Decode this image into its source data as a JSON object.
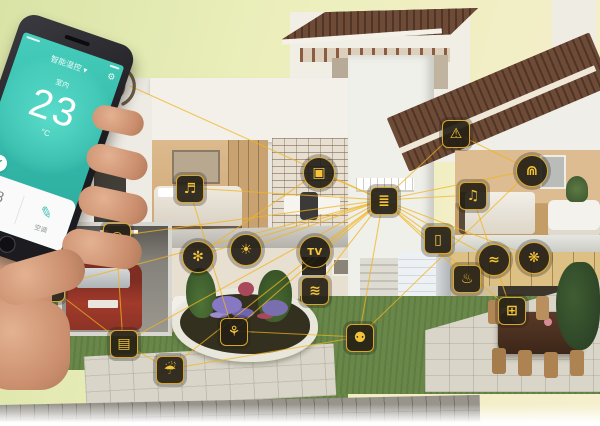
{
  "colors": {
    "accent_line": "#f2b41e",
    "node_glyph": "#f3c339",
    "node_background": "#26201a",
    "app_teal": "#35c0b0",
    "roof_brown": "#5e4030",
    "car_red": "#a13a2b"
  },
  "phone": {
    "app": {
      "title": "智能温控 ▾",
      "gear_icon_glyph": "⚙",
      "room_label": "室内",
      "temperature": "23",
      "unit": "°C",
      "badge_check": "✓",
      "scene_text": "安防模式 · 舒适",
      "sheet_left_value": "18",
      "sheet_left_label": "湿度",
      "sheet_right_glyph": "✎",
      "sheet_right_label": "空调"
    }
  },
  "nodes": [
    {
      "id": "camera",
      "icon": "camera-icon",
      "x": 116,
      "y": 236,
      "shape": "square"
    },
    {
      "id": "ev_charger",
      "icon": "plug-icon",
      "x": 50,
      "y": 287,
      "shape": "square"
    },
    {
      "id": "garage_door",
      "icon": "garage-door-icon",
      "x": 123,
      "y": 343,
      "shape": "square"
    },
    {
      "id": "sprinkler",
      "icon": "sprinkler-icon",
      "x": 169,
      "y": 369,
      "shape": "square"
    },
    {
      "id": "lawn_mower",
      "icon": "lawn-mower-icon",
      "x": 233,
      "y": 331,
      "shape": "square"
    },
    {
      "id": "motion_sensor",
      "icon": "motion-sensor-icon",
      "x": 359,
      "y": 337,
      "shape": "square"
    },
    {
      "id": "speaker",
      "icon": "speaker-icon",
      "x": 189,
      "y": 188,
      "shape": "square"
    },
    {
      "id": "computer",
      "icon": "computer-icon",
      "x": 318,
      "y": 172,
      "shape": "circle"
    },
    {
      "id": "aircon",
      "icon": "air-conditioner-icon",
      "x": 197,
      "y": 256,
      "shape": "circle"
    },
    {
      "id": "bulb",
      "icon": "light-bulb-icon",
      "x": 245,
      "y": 249,
      "shape": "circle"
    },
    {
      "id": "tv",
      "icon": "tv-icon",
      "x": 314,
      "y": 251,
      "shape": "circle",
      "label": "TV"
    },
    {
      "id": "wifi",
      "icon": "wifi-icon",
      "x": 314,
      "y": 290,
      "shape": "square"
    },
    {
      "id": "router",
      "icon": "router-hub-icon",
      "x": 383,
      "y": 200,
      "shape": "square"
    },
    {
      "id": "door_sensor",
      "icon": "door-sensor-icon",
      "x": 437,
      "y": 239,
      "shape": "square"
    },
    {
      "id": "alarm",
      "icon": "alarm-icon",
      "x": 455,
      "y": 133,
      "shape": "square"
    },
    {
      "id": "curtain",
      "icon": "curtain-icon",
      "x": 531,
      "y": 170,
      "shape": "circle"
    },
    {
      "id": "stereo",
      "icon": "stereo-icon",
      "x": 472,
      "y": 195,
      "shape": "square"
    },
    {
      "id": "faucet",
      "icon": "faucet-icon",
      "x": 493,
      "y": 259,
      "shape": "circle"
    },
    {
      "id": "fan",
      "icon": "fan-icon",
      "x": 533,
      "y": 257,
      "shape": "circle"
    },
    {
      "id": "rice_cooker",
      "icon": "rice-cooker-icon",
      "x": 466,
      "y": 278,
      "shape": "square"
    },
    {
      "id": "oven",
      "icon": "oven-icon",
      "x": 511,
      "y": 310,
      "shape": "square"
    },
    {
      "id": "phone_link",
      "icon": "phone-wifi-link",
      "x": 130,
      "y": 86,
      "shape": "none"
    }
  ],
  "connections": [
    [
      "router",
      "alarm"
    ],
    [
      "router",
      "curtain"
    ],
    [
      "router",
      "stereo"
    ],
    [
      "router",
      "door_sensor"
    ],
    [
      "router",
      "faucet"
    ],
    [
      "router",
      "fan"
    ],
    [
      "router",
      "rice_cooker"
    ],
    [
      "router",
      "oven"
    ],
    [
      "router",
      "tv"
    ],
    [
      "router",
      "bulb"
    ],
    [
      "router",
      "aircon"
    ],
    [
      "router",
      "wifi"
    ],
    [
      "router",
      "computer"
    ],
    [
      "router",
      "speaker"
    ],
    [
      "router",
      "camera"
    ],
    [
      "router",
      "motion_sensor"
    ],
    [
      "router",
      "lawn_mower"
    ],
    [
      "router",
      "sprinkler"
    ],
    [
      "router",
      "garage_door"
    ],
    [
      "router",
      "ev_charger"
    ],
    [
      "router",
      "phone_link"
    ],
    [
      "camera",
      "garage_door"
    ],
    [
      "ev_charger",
      "garage_door"
    ],
    [
      "garage_door",
      "sprinkler"
    ],
    [
      "lawn_mower",
      "motion_sensor"
    ],
    [
      "curtain",
      "motion_sensor"
    ],
    [
      "speaker",
      "lawn_mower"
    ],
    [
      "computer",
      "aircon"
    ],
    [
      "stereo",
      "oven"
    ],
    [
      "alarm",
      "curtain"
    ],
    [
      "sprinkler",
      "motion_sensor"
    ]
  ]
}
